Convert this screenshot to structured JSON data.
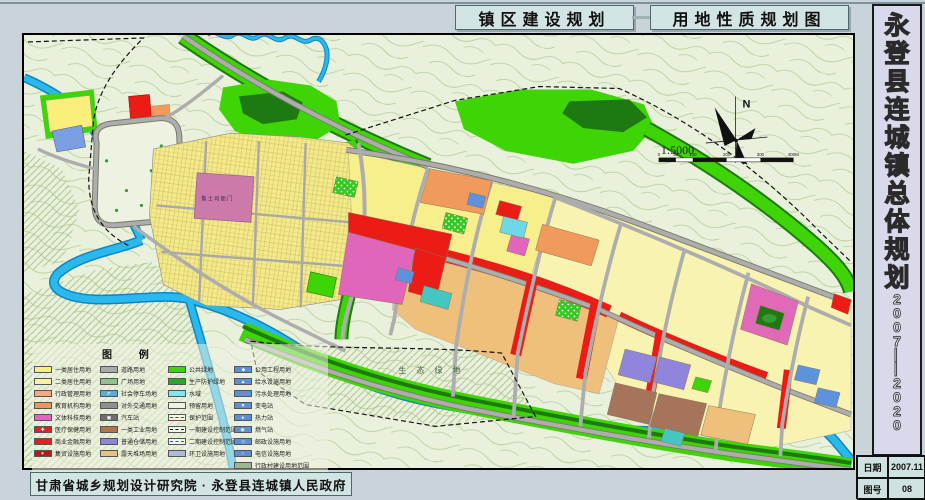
{
  "header": {
    "title_left": "镇区建设规划",
    "title_right": "用地性质规划图"
  },
  "sidebar": {
    "title": "永登县连城镇总体规划",
    "years": "2007——2020",
    "table": [
      {
        "label": "日期",
        "value": "2007.11"
      },
      {
        "label": "图号",
        "value": "08"
      }
    ]
  },
  "footer": {
    "credit": "甘肃省城乡规划设计研究院 · 永登县连城镇人民政府"
  },
  "map": {
    "north": "N",
    "scale": "1:5000",
    "scale_ticks": [
      "0",
      "50",
      "100",
      "200",
      "300",
      "400M"
    ],
    "eco_label": "生 态 绿 地",
    "heritage_label": "鲁土司衙门"
  },
  "legend": {
    "title": "图  例",
    "columns": [
      {
        "items": [
          {
            "label": "一类居住用地",
            "sw": {
              "bg": "#f9ef7a"
            }
          },
          {
            "label": "二类居住用地",
            "sw": {
              "bg": "#f9f2a6"
            }
          },
          {
            "label": "行政管理用地",
            "sw": {
              "bg": "#f2ab7e"
            }
          },
          {
            "label": "教育机构用地",
            "sw": {
              "bg": "#ee9752"
            }
          },
          {
            "label": "文体科技用地",
            "sw": {
              "bg": "#e263c0"
            }
          },
          {
            "label": "医疗保健用地",
            "sw": {
              "bg": "#e91c22",
              "glyph": "✚",
              "glyph_color": "#ffffff"
            }
          },
          {
            "label": "商业金融用地",
            "sw": {
              "bg": "#e91c22"
            }
          },
          {
            "label": "集贸设施用地",
            "sw": {
              "bg": "#c3131a",
              "glyph": "✶",
              "glyph_color": "#ffffff"
            }
          }
        ]
      },
      {
        "items": [
          {
            "label": "道路用地",
            "sw": {
              "bg": "#a9a9a9"
            }
          },
          {
            "label": "广场用地",
            "sw": {
              "bg": "#8cc48c"
            }
          },
          {
            "label": "社会停车场地",
            "sw": {
              "bg": "#56b0d6",
              "glyph": "P",
              "glyph_color": "#ffffff"
            }
          },
          {
            "label": "对外交通用地",
            "sw": {
              "bg": "#8f8f8f"
            }
          },
          {
            "label": "汽车站",
            "sw": {
              "bg": "#6e6e6e",
              "glyph": "▣",
              "glyph_color": "#ffffff"
            }
          },
          {
            "label": "一类工业用地",
            "sw": {
              "bg": "#b5724c"
            }
          },
          {
            "label": "普通仓储用地",
            "sw": {
              "bg": "#8f86dc"
            }
          },
          {
            "label": "露天堆场用地",
            "sw": {
              "bg": "#e9c083"
            }
          }
        ]
      },
      {
        "items": [
          {
            "label": "公共绿地",
            "sw": {
              "bg": "#3ed405"
            }
          },
          {
            "label": "生产防护绿地",
            "sw": {
              "bg": "#2aa82a"
            }
          },
          {
            "label": "水域",
            "sw": {
              "bg": "#7de8f0"
            }
          },
          {
            "label": "预留用地",
            "sw": {
              "bg": "#eef2e2"
            }
          },
          {
            "label": "保护范围",
            "sw": {
              "bg": "#f2f5ea",
              "line": "red-dash"
            }
          },
          {
            "label": "一期建设控制范围",
            "sw": {
              "bg": "#f2f5ea",
              "line": "black-dashdot"
            }
          },
          {
            "label": "二期建设控制范围",
            "sw": {
              "bg": "#f2f5ea",
              "line": "blue-dash"
            }
          },
          {
            "label": "环卫设施用地",
            "sw": {
              "bg": "#aebadc"
            }
          }
        ]
      },
      {
        "items": [
          {
            "label": "公用工程用地",
            "sw": {
              "bg": "#5b8fd8",
              "glyph": "◆",
              "glyph_color": "#ffffff"
            }
          },
          {
            "label": "给水设施用地",
            "sw": {
              "bg": "#5b8fd8",
              "glyph": "▲",
              "glyph_color": "#ffffff"
            }
          },
          {
            "label": "污水处理用地",
            "sw": {
              "bg": "#5b8fd8",
              "glyph": "●",
              "glyph_color": "#ff5544"
            }
          },
          {
            "label": "变电站",
            "sw": {
              "bg": "#5b8fd8",
              "glyph": "▼",
              "glyph_color": "#ffffff"
            }
          },
          {
            "label": "热力站",
            "sw": {
              "bg": "#5b8fd8",
              "glyph": "●",
              "glyph_color": "#ffffff"
            }
          },
          {
            "label": "燃气站",
            "sw": {
              "bg": "#5b8fd8",
              "glyph": "◉",
              "glyph_color": "#ffffff"
            }
          },
          {
            "label": "邮政设施用地",
            "sw": {
              "bg": "#5b8fd8",
              "glyph": "◇",
              "glyph_color": "#ffffff"
            }
          },
          {
            "label": "电信设施用地",
            "sw": {
              "bg": "#5b8fd8",
              "glyph": "○",
              "glyph_color": "#ffffff"
            }
          },
          {
            "label": "行政村建设用地范围",
            "sw": {
              "bg": "#9fb894"
            }
          }
        ]
      }
    ]
  }
}
